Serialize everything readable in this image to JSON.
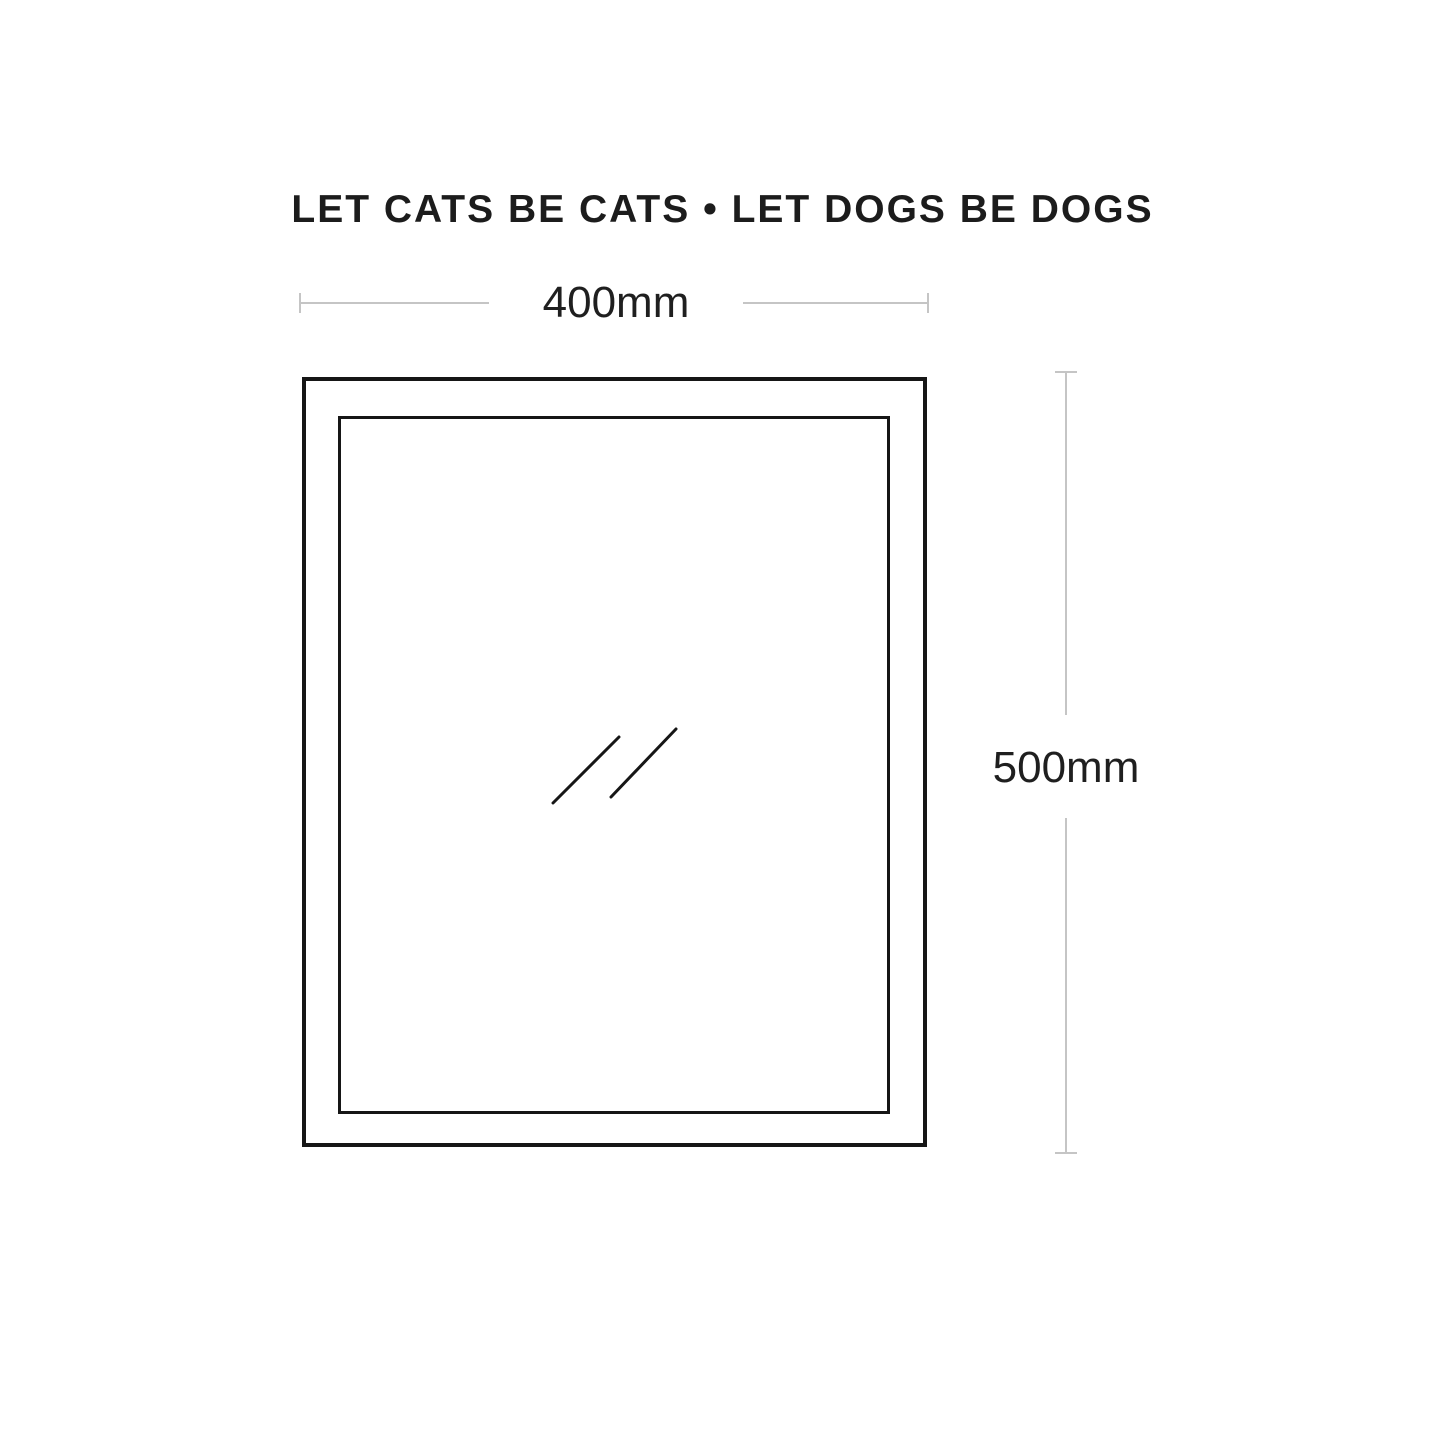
{
  "theme": {
    "page-bg": "#ffffff",
    "frame-color": "#161616",
    "dim-line-color": "#c5c5c5",
    "dim-text-color": "#1f1f1f",
    "title-color": "#1c1c1c"
  },
  "title": {
    "text": "LET CATS BE CATS • LET DOGS BE DOGS"
  },
  "diagram": {
    "type": "product-dimension-drawing",
    "subject": "pet-door-frame-with-glass-flap",
    "width_dimension": {
      "label": "400mm"
    },
    "height_dimension": {
      "label": "500mm"
    }
  }
}
